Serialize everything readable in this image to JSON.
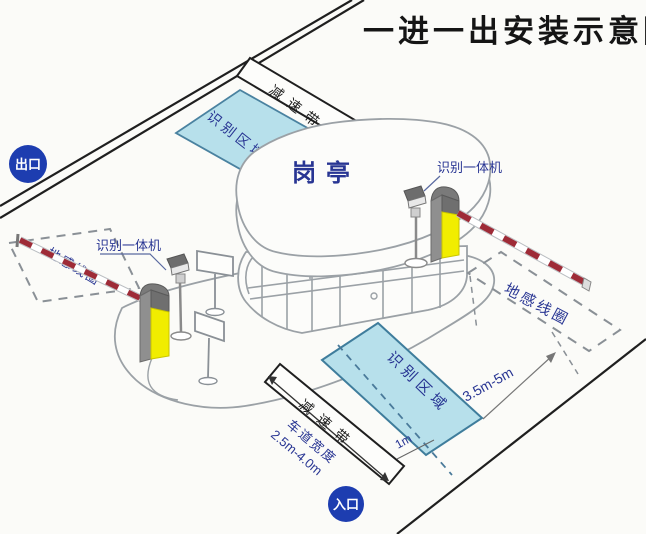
{
  "title": "一进一出安装示意图",
  "badges": {
    "exit": "出口",
    "entrance": "入口"
  },
  "labels": {
    "booth": "岗亭",
    "recognition_zone": "识别区域",
    "ground_loop": "地感线圈",
    "camera_unit": "识别一体机",
    "speed_bump": "减速带",
    "lane_width_title": "车道宽度",
    "lane_width_value": "2.5m-4.0m",
    "loop_distance": "3.5m-5m",
    "loop_offset": "1m"
  },
  "colors": {
    "badge_blue": "#1d3db0",
    "label_navy": "#283593",
    "zone_fill": "#b7e0eb",
    "zone_border": "#4a82a0",
    "barrier_yellow": "#f1ed00",
    "barrier_gray": "#8f8f8f",
    "barrier_top_gray": "#6f6f6f",
    "arm_red": "#9e2b37",
    "line_black": "#1f1f1f",
    "line_gray": "#9ba1a6",
    "background": "#fbfbf8"
  }
}
